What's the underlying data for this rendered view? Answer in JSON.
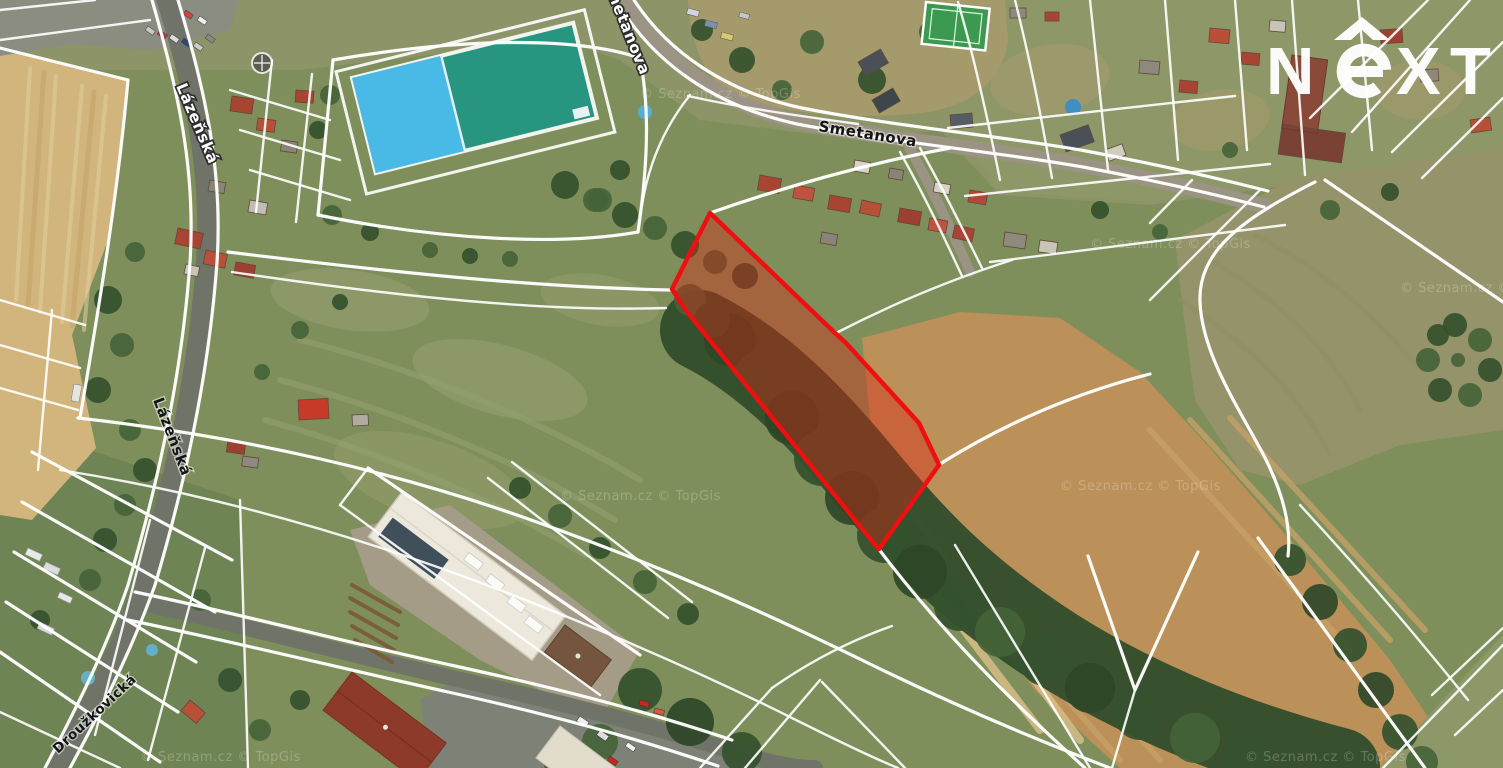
{
  "window": {
    "width": 1503,
    "height": 768
  },
  "map": {
    "type": "satellite-cadastral-view",
    "credit": "© Seznam.cz © TopGis",
    "streets": {
      "smetanova_top": "Smetanova",
      "lazenska_north": "Lázeňská",
      "smetanova": "Smetanova",
      "lazenska_south": "Lázeňská",
      "drouzkovicka": "Droužkovická"
    },
    "highlight": {
      "stroke": "#ee1010",
      "fill": "#dd2211"
    },
    "pool": {
      "light": "#49b9e6",
      "dark": "#27957f"
    }
  },
  "brand": {
    "name": "NEXT",
    "letters": {
      "n": "N",
      "x": "X",
      "t": "T"
    }
  }
}
